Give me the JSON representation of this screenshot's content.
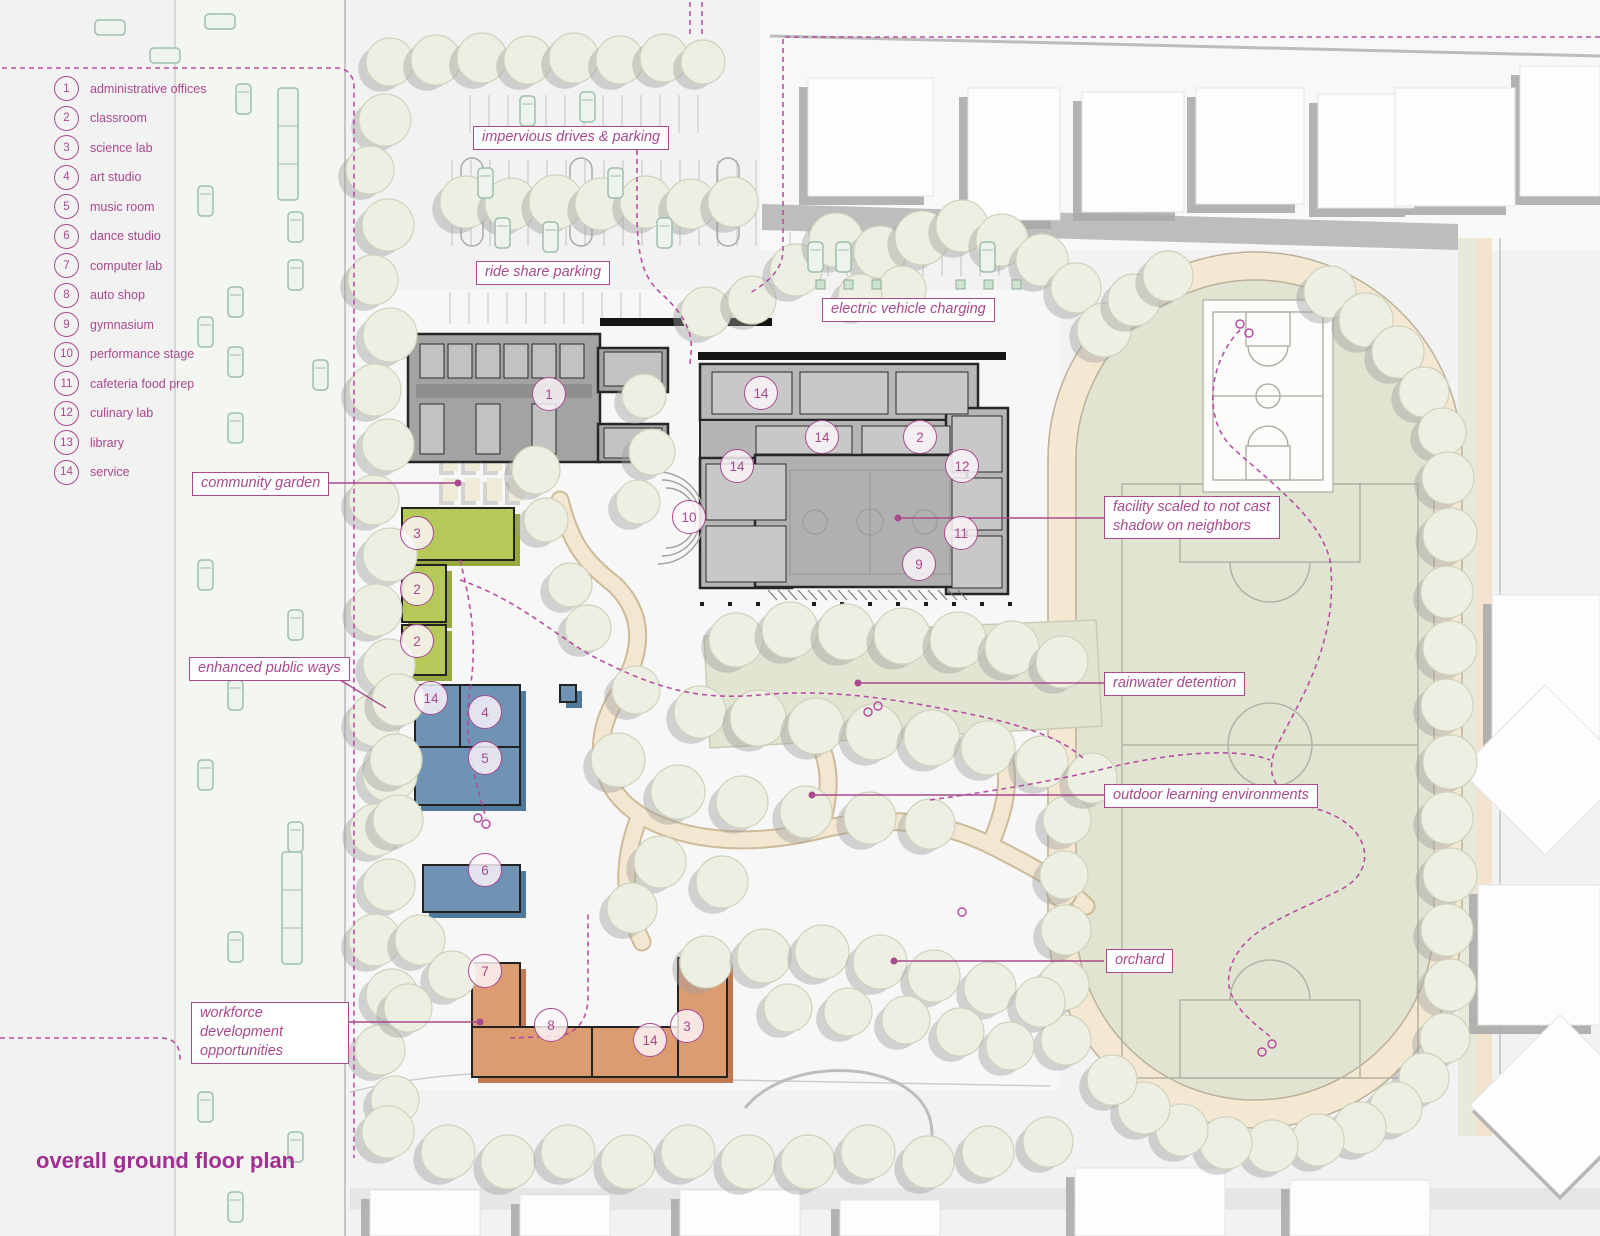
{
  "title": "overall ground floor plan",
  "legend": {
    "items": [
      {
        "num": "1",
        "label": "administrative offices"
      },
      {
        "num": "2",
        "label": "classroom"
      },
      {
        "num": "3",
        "label": "science lab"
      },
      {
        "num": "4",
        "label": "art studio"
      },
      {
        "num": "5",
        "label": "music room"
      },
      {
        "num": "6",
        "label": "dance studio"
      },
      {
        "num": "7",
        "label": "computer lab"
      },
      {
        "num": "8",
        "label": "auto shop"
      },
      {
        "num": "9",
        "label": "gymnasium"
      },
      {
        "num": "10",
        "label": "performance stage"
      },
      {
        "num": "11",
        "label": "cafeteria food prep"
      },
      {
        "num": "12",
        "label": "culinary lab"
      },
      {
        "num": "13",
        "label": "library"
      },
      {
        "num": "14",
        "label": "service"
      }
    ]
  },
  "callouts": {
    "impervious": "impervious drives & parking",
    "rideshare": "ride share parking",
    "ev": "electric vehicle charging",
    "garden": "community garden",
    "publicways": "enhanced public ways",
    "workforce": "workforce development opportunities",
    "facility": "facility scaled to not cast shadow on neighbors",
    "rainwater": "rainwater detention",
    "outdoor": "outdoor learning environments",
    "orchard": "orchard"
  },
  "plan_markers": [
    "1",
    "14",
    "14",
    "14",
    "2",
    "12",
    "10",
    "11",
    "9",
    "3",
    "2",
    "2",
    "14",
    "4",
    "5",
    "6",
    "7",
    "8",
    "14",
    "3"
  ],
  "colors": {
    "accent": "#a84a8e",
    "title": "#a12f92",
    "building_green": "#b6c958",
    "building_blue": "#6e93b4",
    "building_orange": "#dc9c72",
    "building_gray": "#b5b5b5",
    "wall_dark": "#262626",
    "track_ring": "#f4e8d2",
    "field_green": "#e1e4d0",
    "tree": "#edefe2",
    "path_tan": "#f3e7d1"
  }
}
